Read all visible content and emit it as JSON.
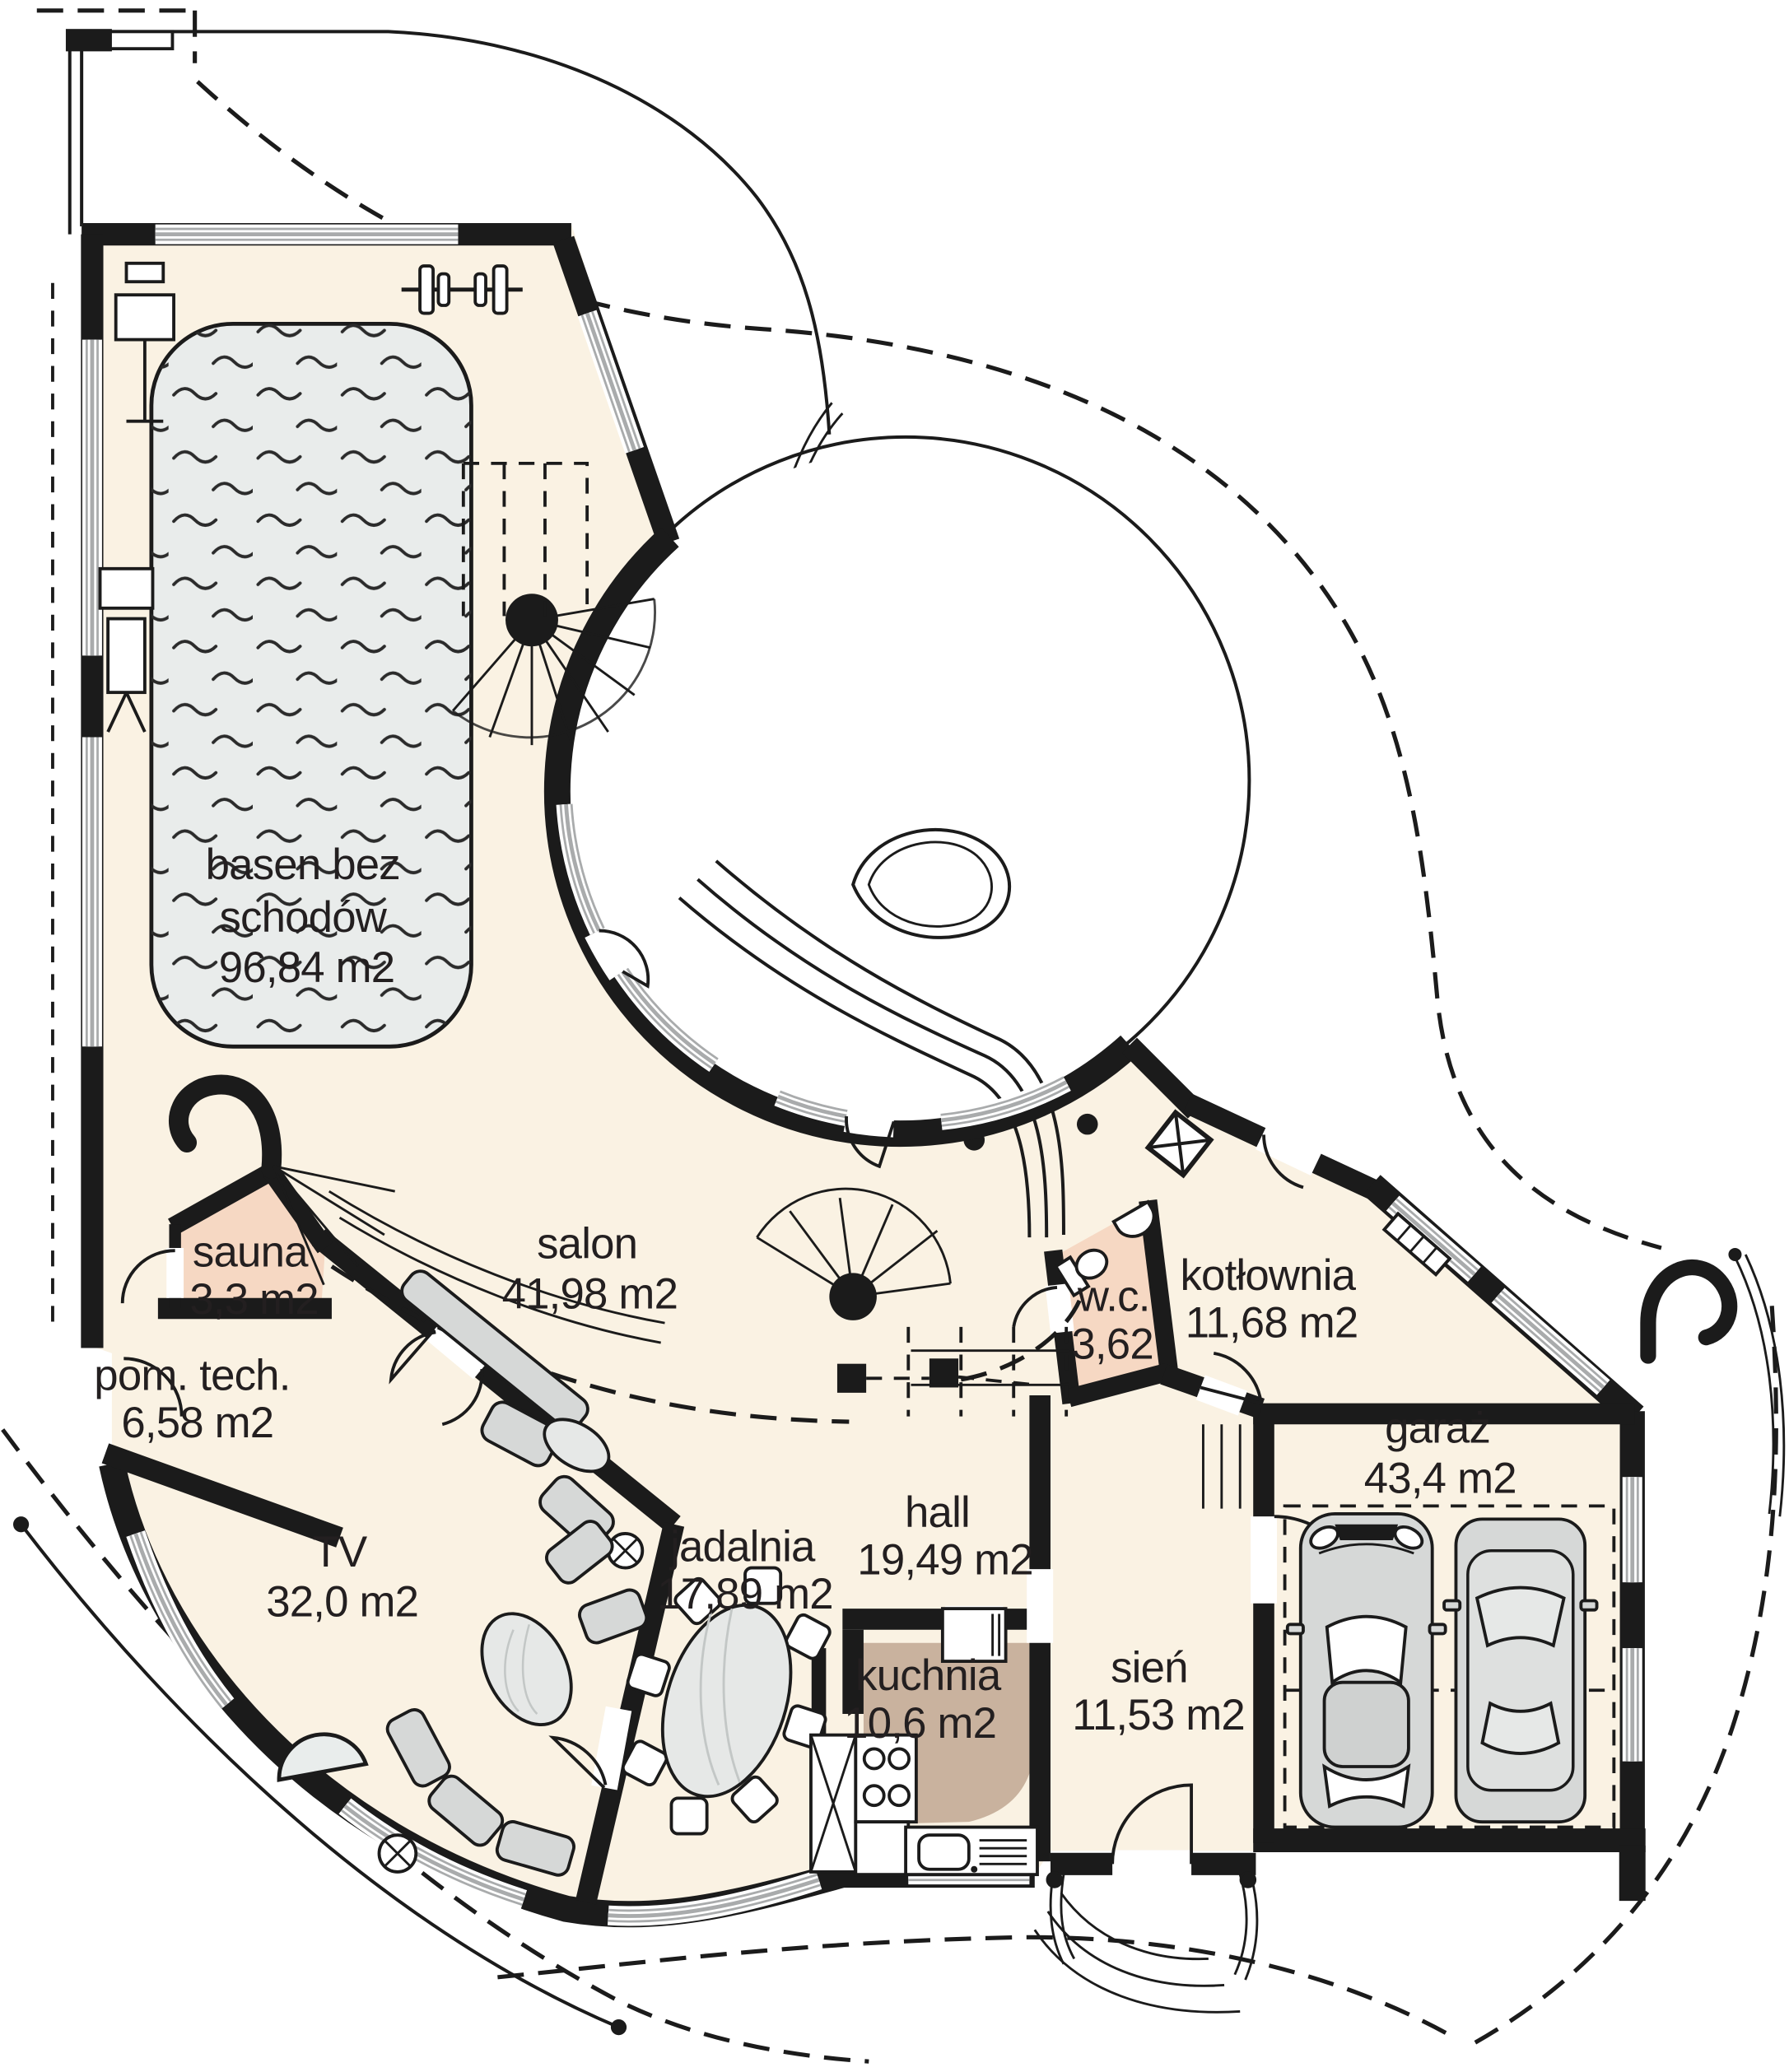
{
  "plan_type": "floor-plan",
  "colors": {
    "wall": "#1b1b1b",
    "floor_cream": "#faf2e3",
    "pool_water": "#e9eceb",
    "sauna_salmon": "#f6d8c3",
    "kitchen_tan": "#c9b29e",
    "window_gray": "#a9abac",
    "furniture_gray": "#d6d8d7"
  },
  "rooms": {
    "basen": {
      "line1": "basen bez",
      "line2": "schodów",
      "area": "96,84 m2"
    },
    "sauna": {
      "name": "sauna",
      "area": "3,3 m2"
    },
    "pom_tech": {
      "name": "pom. tech.",
      "area": "6,58 m2"
    },
    "salon": {
      "name": "salon",
      "area": "41,98 m2"
    },
    "tv": {
      "name": "TV",
      "area": "32,0 m2"
    },
    "jadalnia": {
      "name": "jadalnia",
      "area": "17,89 m2"
    },
    "hall": {
      "name": "hall",
      "area": "19,49 m2"
    },
    "kuchnia": {
      "name": "kuchnia",
      "area": "10,6 m2"
    },
    "wc": {
      "name": "w.c.",
      "area": "3,62"
    },
    "kotlownia": {
      "name": "kotłownia",
      "area": "11,68 m2"
    },
    "sien": {
      "name": "sień",
      "area": "11,53 m2"
    },
    "garaz": {
      "name": "garaż",
      "area": "43,4 m2"
    }
  }
}
